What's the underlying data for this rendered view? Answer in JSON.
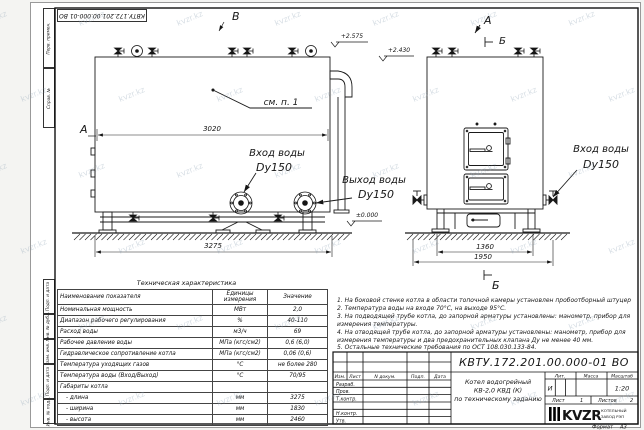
{
  "watermark": "kvzr.kz",
  "stamp_rotated": "КВТУ.172.201.00.000-01 ВО",
  "frame_labels": [
    "Перв. примен.",
    "Справ. №",
    "Подп. и дата",
    "Инв. № дубл.",
    "Взам. инв. №",
    "Подп. и дата",
    "Инв. № подл."
  ],
  "drawing": {
    "section_b_top": "В",
    "section_a_left": "А",
    "section_a_right": "А",
    "section_b_right": "Б",
    "section_b_bottom": "Б",
    "callout_see_item": "см. п. 1",
    "dims": {
      "length_shell": "3020",
      "length_overall": "3275",
      "width_frame": "1360",
      "width_overall": "1950"
    },
    "elevations": {
      "top": "+2.575",
      "boiler_top": "+2.430",
      "ground": "±0.000"
    },
    "labels": {
      "inlet_left_1": "Вход воды",
      "inlet_left_2": "Dy150",
      "outlet_1": "Выход воды",
      "outlet_2": "Dy150",
      "inlet_right_1": "Вход воды",
      "inlet_right_2": "Dy150"
    }
  },
  "table": {
    "title": "Техническая характеристика",
    "headers": [
      "Наименование показателя",
      "Единицы измерения",
      "Значение"
    ],
    "rows": [
      [
        "Номинальная мощность",
        "МВт",
        "2,0"
      ],
      [
        "Диапазон рабочего регулирования",
        "%",
        "40-110"
      ],
      [
        "Расход воды",
        "м3/ч",
        "69"
      ],
      [
        "Рабочее давление воды",
        "МПа (кгс/см2)",
        "0,6 (6,0)"
      ],
      [
        "Гидравлическое сопротивление котла",
        "МПа (кгс/см2)",
        "0,06 (0,6)"
      ],
      [
        "Температура уходящих газов",
        "°С",
        "не более 280"
      ],
      [
        "Температура воды (Вход/Выход)",
        "°С",
        "70/95"
      ],
      [
        "Габариты котла",
        "",
        ""
      ],
      [
        "- длина",
        "мм",
        "3275"
      ],
      [
        "- ширина",
        "мм",
        "1830"
      ],
      [
        "- высота",
        "мм",
        "2460"
      ]
    ]
  },
  "notes": {
    "items": [
      "1.  На боковой стенке котла в области топочной камеры установлен пробоотборный штуцер",
      "2.  Температура воды на входе 70°С, на выходе 95°С.",
      "3.  На подводящей трубе котла, до запорной арматуры установлены: манометр, прибор для измерения температуры.",
      "4.  На отводящей трубе котла, до запорной арматуры установлены: манометр, прибор для измерения температуры и два предохранительных клапана Ду не менее 40 мм.",
      "5.  Остальные технические требования по ОСТ 108.030.133-84."
    ]
  },
  "title_block": {
    "doc_number": "КВТУ.172.201.00.000-01 ВО",
    "name_lines": [
      "Котел водогрейный",
      "КВ-2,0 КВД (К)",
      "по техническому заданию"
    ],
    "header_cols": [
      "Изм.",
      "Лист",
      "N докум.",
      "Подп.",
      "Дата"
    ],
    "staff_rows": [
      "Разраб.",
      "Пров.",
      "Т.контр.",
      "Н.контр.",
      "Утв."
    ],
    "lit_label": "Лит.",
    "mass_label": "Масса",
    "scale_label": "Масштаб",
    "lit_value": "И",
    "scale_value": "1:20",
    "sheet_label": "Лист",
    "sheet_value": "1",
    "sheets_label": "Листов",
    "sheets_value": "2",
    "company": {
      "logo": "KVZR",
      "name_line1": "КОТЕЛЬНЫЙ",
      "name_line2": "ЗАВОД РЭП"
    },
    "format_label": "Формат",
    "format_value": "А3"
  }
}
